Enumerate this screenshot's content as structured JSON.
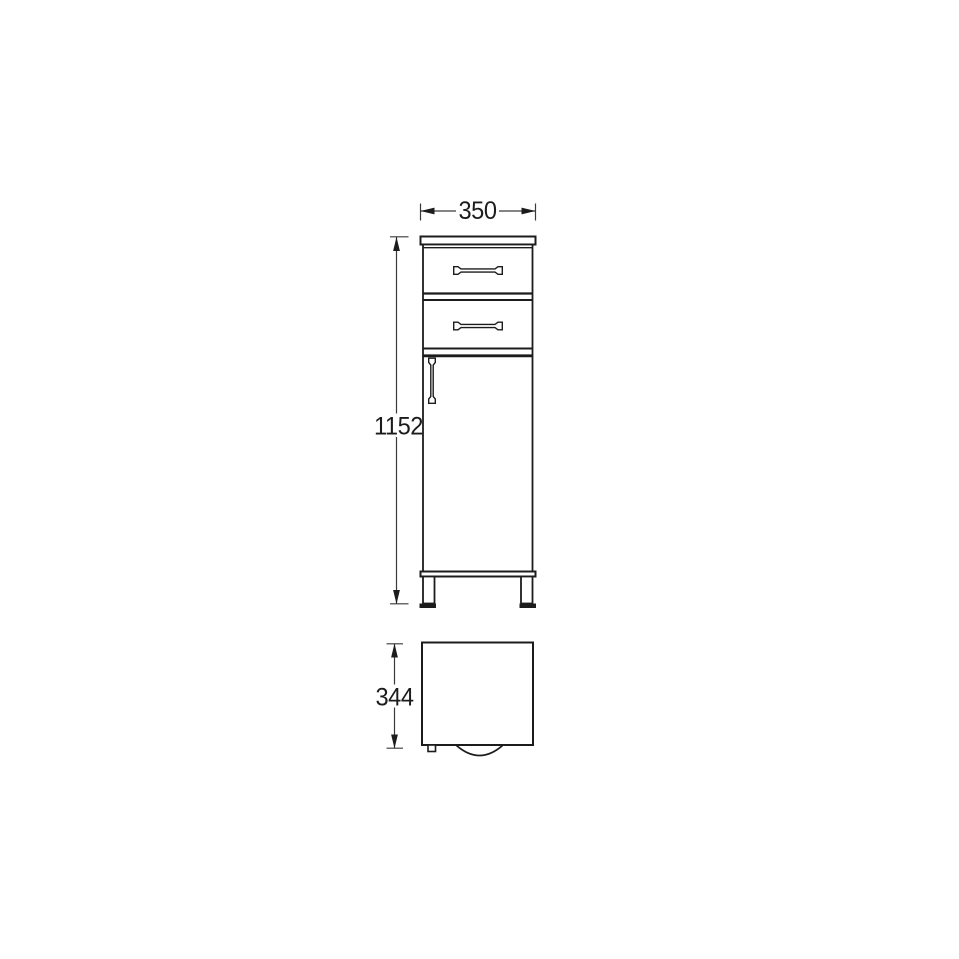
{
  "page": {
    "background": "#ffffff"
  },
  "drawing": {
    "kind": "furniture-dimension-diagram",
    "colors": {
      "object_line": "#1c1c1c",
      "dimension_line": "#3a3a3a",
      "text": "#1c1c1c",
      "background": "#ffffff"
    },
    "views": {
      "front": {
        "label": "front-view"
      },
      "plan": {
        "label": "plan-view"
      }
    },
    "dimensions": {
      "width": "350",
      "height": "1152",
      "depth": "344"
    }
  }
}
